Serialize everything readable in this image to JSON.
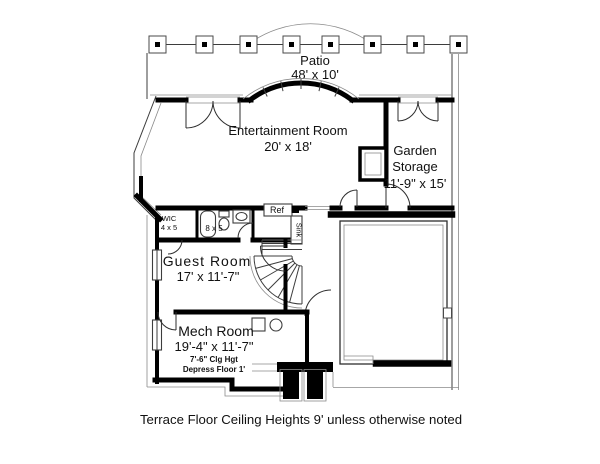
{
  "caption": "Terrace Floor Ceiling Heights 9' unless otherwise noted",
  "patio": {
    "label": "Patio",
    "dims": "48' x 10'"
  },
  "entertainment_room": {
    "label": "Entertainment Room",
    "dims": "20' x 18'"
  },
  "garden_storage": {
    "label_line1": "Garden",
    "label_line2": "Storage",
    "dims": "11'-9\" x 15'"
  },
  "guest_room": {
    "label": "Guest Room",
    "dims": "17' x 11'-7\""
  },
  "mech_room": {
    "label": "Mech Room",
    "dims": "19'-4\" x 11'-7\"",
    "ceiling_note": "7'-6\" Clg Hgt",
    "floor_note": "Depress Floor 1'"
  },
  "wic": {
    "label": "WIC",
    "dims": "4 x 5"
  },
  "bath": {
    "dims": "8 x 5"
  },
  "kitchenette": {
    "ref_label": "Ref",
    "sink_label": "Sink"
  },
  "colors": {
    "wall": "#000000",
    "thin_line": "#3d3d3d",
    "light_line": "#8a8a8a",
    "text": "#111111",
    "background": "#ffffff"
  }
}
